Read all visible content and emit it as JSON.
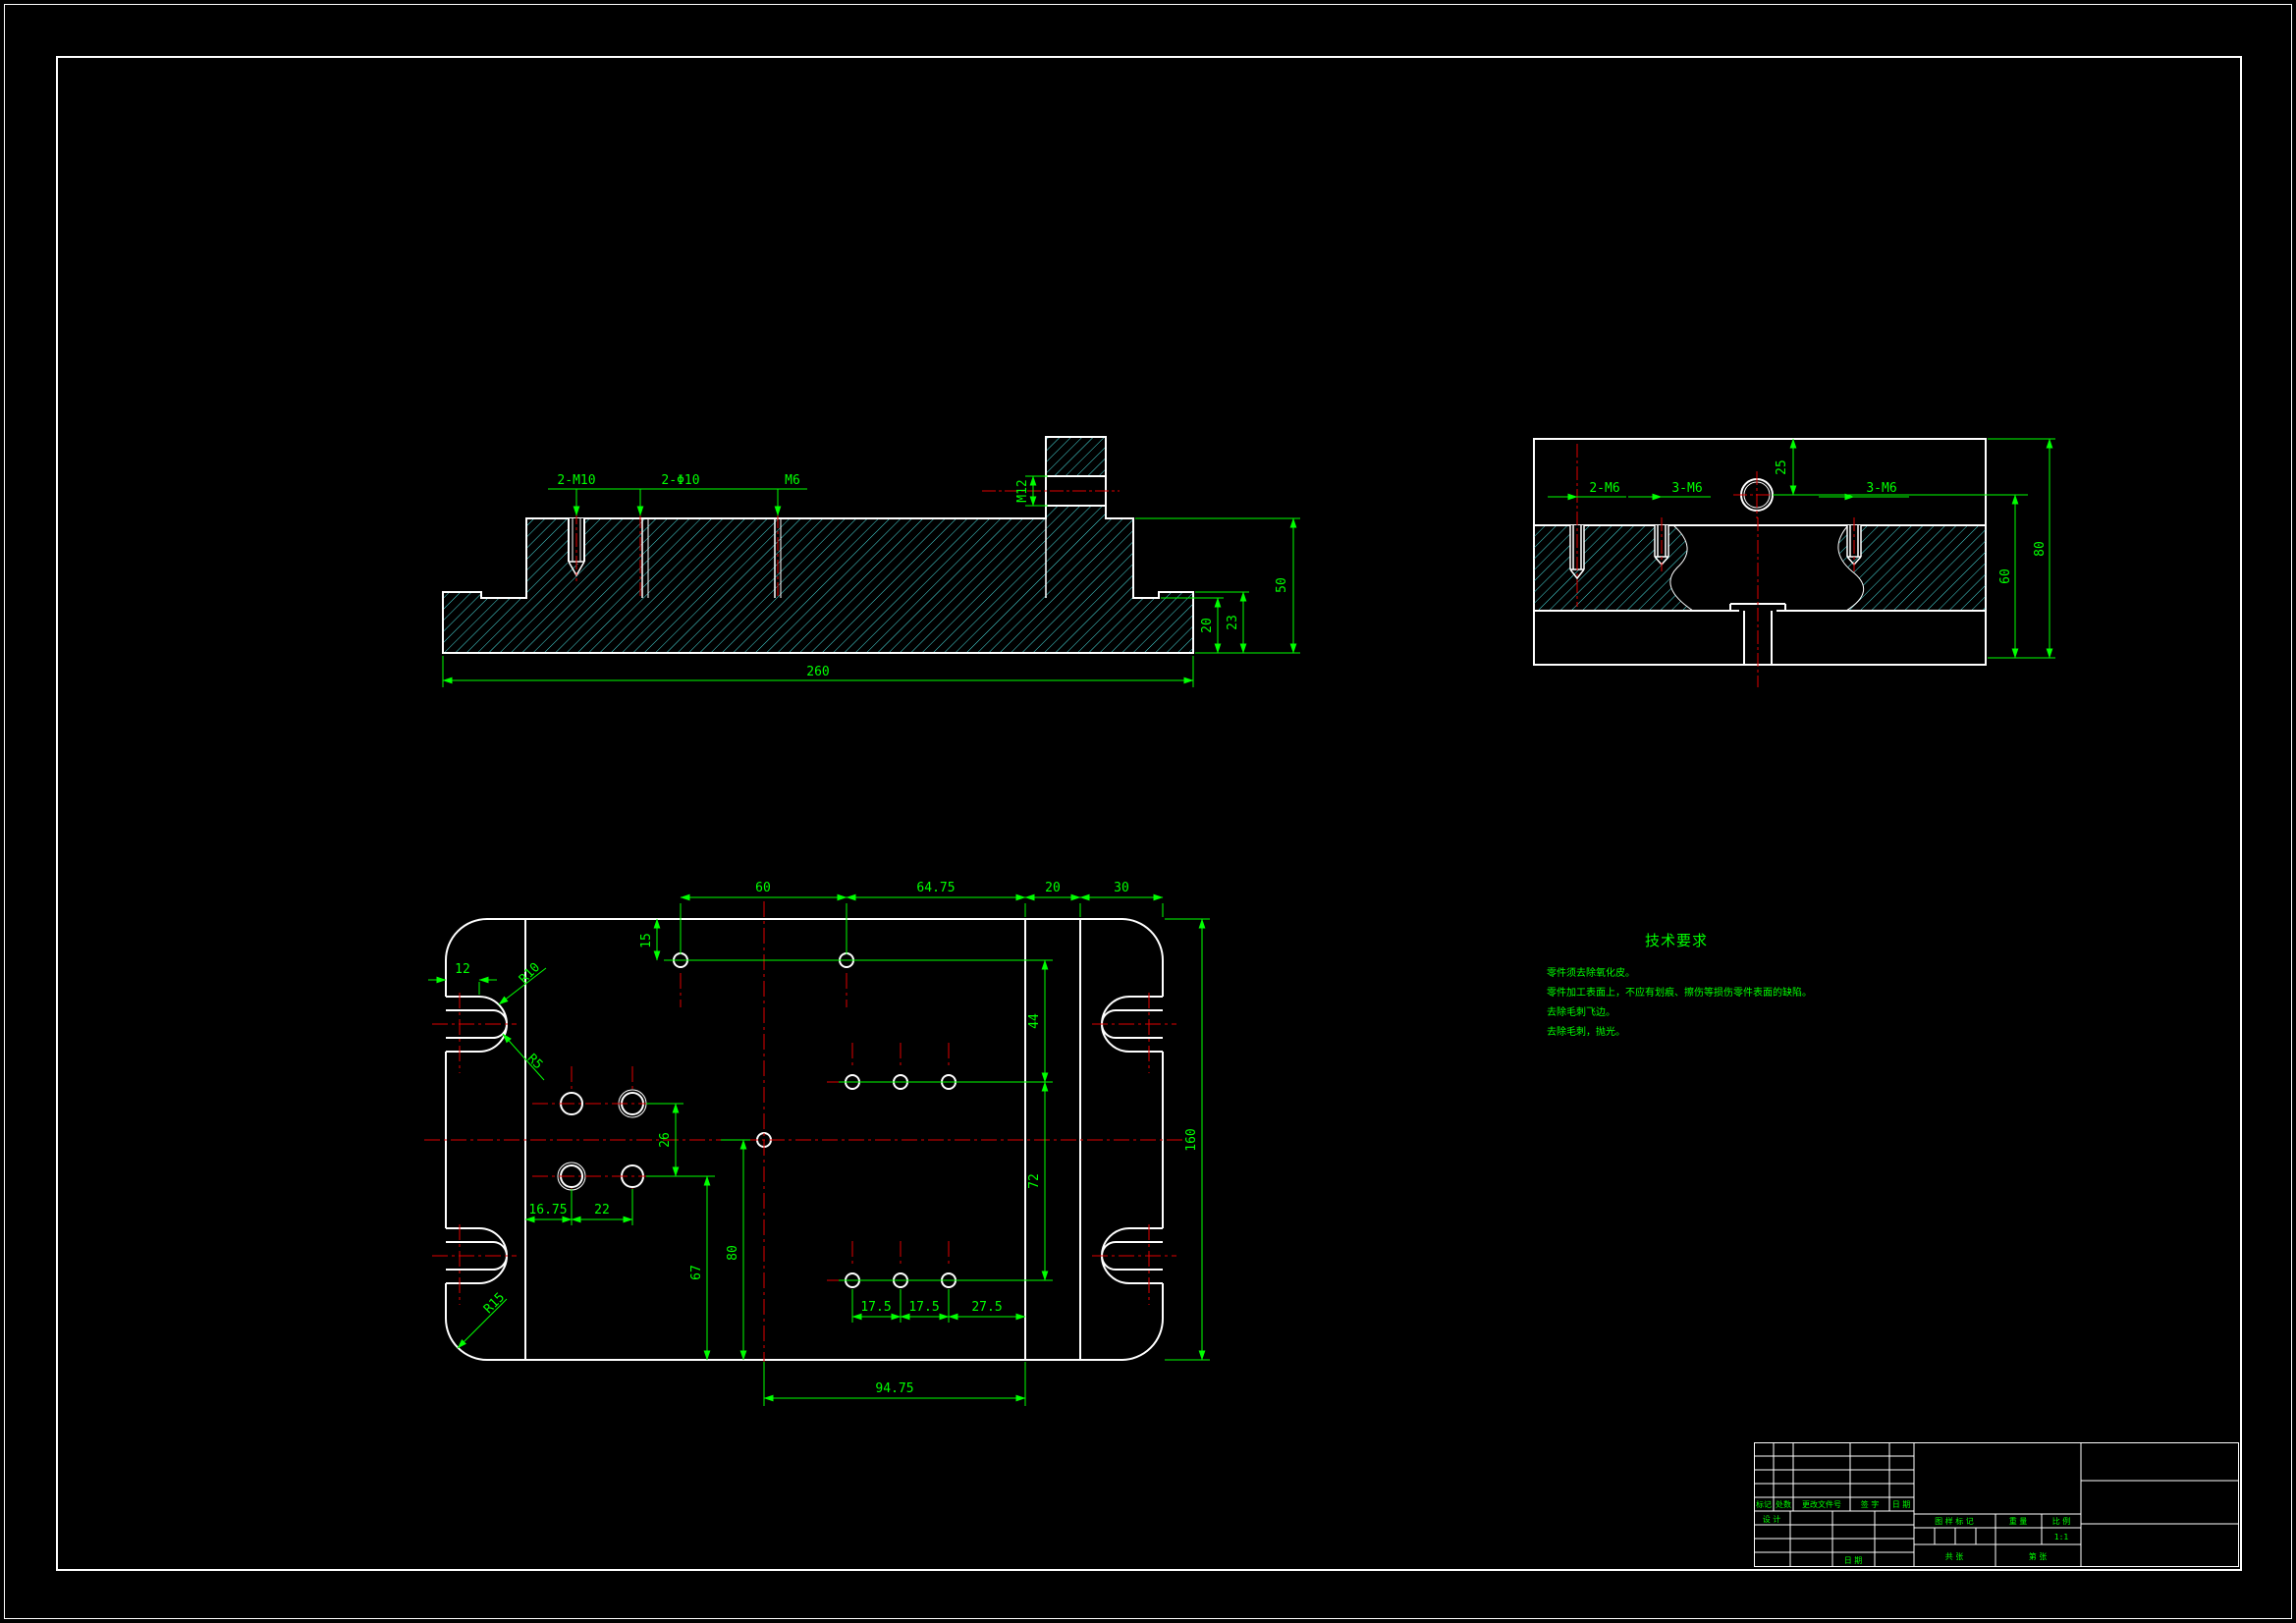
{
  "page": {
    "background": "#000000",
    "frame_color": "#ffffff",
    "dim_color": "#00ff00",
    "centerline_color": "#e00000",
    "hatch_color": "#49dede"
  },
  "front_view": {
    "labels": {
      "tapped_holes": "2-M10",
      "through_holes": "2-Φ10",
      "tapped_hole_mid": "M6",
      "block_thread": "M12"
    },
    "dims": {
      "overall_length": "260",
      "body_height": "50",
      "step_inner": "20",
      "step_outer": "23"
    }
  },
  "side_view": {
    "labels": {
      "tapped_left": "2-M6",
      "tapped_mid": "3-M6",
      "tapped_right": "3-M6"
    },
    "dims": {
      "hole_offset": "25",
      "inner_height": "60",
      "overall_height": "80"
    }
  },
  "plan_view": {
    "dims": {
      "slot_depth": "12",
      "slot_outer_radius": "R10",
      "slot_inner_radius": "R5",
      "corner_radius": "R15",
      "row1_offset": "15",
      "top_span1": "60",
      "top_span2": "64.75",
      "top_span3": "20",
      "top_span4": "30",
      "row_gap_upper": "44",
      "row_gap_lower": "72",
      "overall_width": "160",
      "pair_gap": "26",
      "col_offset1": "16.75",
      "col_offset2": "22",
      "pair_row_to_edge": "67",
      "center_to_edge": "80",
      "hole_span1": "17.5",
      "hole_span2": "17.5",
      "hole_span3": "27.5",
      "bottom_span": "94.75"
    }
  },
  "tech_requirements": {
    "title": "技术要求",
    "lines": [
      "零件须去除氧化皮。",
      "零件加工表面上，不应有划痕、擦伤等损伤零件表面的缺陷。",
      "去除毛刺飞边。",
      "去除毛刺，抛光。"
    ]
  },
  "title_block": {
    "revision_headers": [
      "标记",
      "处数",
      "更改文件号",
      "签 字",
      "日 期"
    ],
    "designer_label": "设 计",
    "date_label": "日 期",
    "mark_label": "图 样 标 记",
    "weight_label": "重 量",
    "scale_label": "比 例",
    "scale_value": "1:1",
    "total_sheets_label": "共  张",
    "sheet_number_label": "第  张"
  }
}
